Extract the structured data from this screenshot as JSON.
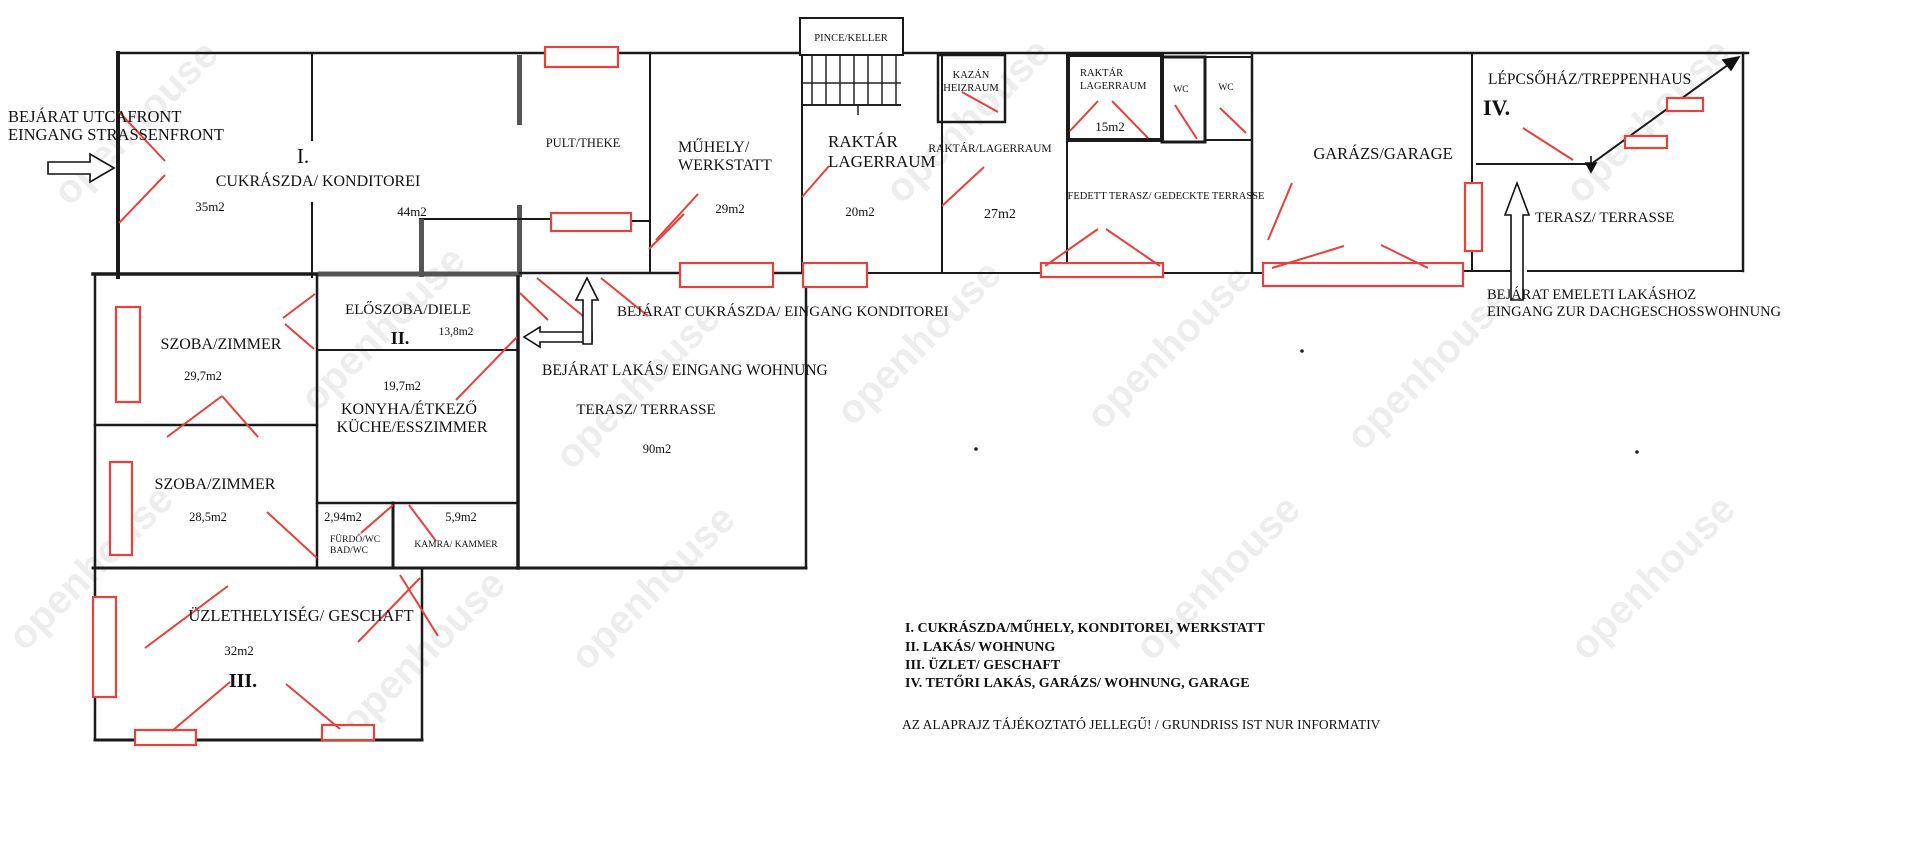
{
  "watermark": "openhouse",
  "entrances": {
    "street_line1": "BEJÁRAT UTCAFRONT",
    "street_line2": "EINGANG STRASSENFRONT",
    "konditorei": "BEJÁRAT CUKRÁSZDA/ EINGANG KONDITOREI",
    "wohnung": "BEJÁRAT LAKÁS/ EINGANG WOHNUNG",
    "upper_line1": "BEJÁRAT EMELETI LAKÁSHOZ",
    "upper_line2": "EINGANG ZUR DACHGESCHOSSWOHNUNG"
  },
  "rooms": {
    "cukraszda": {
      "numeral": "I.",
      "label": "CUKRÁSZDA/ KONDITOREI",
      "area1": "35m2",
      "area2": "44m2"
    },
    "pult": {
      "label": "PULT/THEKE"
    },
    "muhely": {
      "line1": "MŰHELY/",
      "line2": "WERKSTATT",
      "area": "29m2"
    },
    "pince": {
      "label": "PINCE/KELLER"
    },
    "raktar20": {
      "line1": "RAKTÁR",
      "line2": "LAGERRAUM",
      "area": "20m2"
    },
    "kazan": {
      "line1": "KAZÁN",
      "line2": "HEIZRAUM"
    },
    "raktar27": {
      "label": "RAKTÁR/LAGERRAUM",
      "area": "27m2"
    },
    "raktar15": {
      "line1": "RAKTÁR",
      "line2": "LAGERRAUM",
      "area": "15m2"
    },
    "wc1": {
      "label": "WC"
    },
    "wc2": {
      "label": "WC"
    },
    "fedett_terasz": {
      "label": "FEDETT TERASZ/ GEDECKTE TERRASSE"
    },
    "garazs": {
      "label": "GARÁZS/GARAGE"
    },
    "lepcsohaz": {
      "label": "LÉPCSŐHÁZ/TREPPENHAUS",
      "numeral": "IV."
    },
    "terasz_emeleti": {
      "label": "TERASZ/ TERRASSE"
    },
    "szoba1": {
      "label": "SZOBA/ZIMMER",
      "area": "29,7m2"
    },
    "eloszoba": {
      "label": "ELŐSZOBA/DIELE",
      "numeral": "II.",
      "area": "13,8m2"
    },
    "konyha": {
      "area": "19,7m2",
      "line1": "KONYHA/ÉTKEZŐ",
      "line2": "KÜCHE/ESSZIMMER"
    },
    "terasz": {
      "label": "TERASZ/ TERRASSE",
      "area": "90m2"
    },
    "szoba2": {
      "label": "SZOBA/ZIMMER",
      "area": "28,5m2"
    },
    "furdo": {
      "area": "2,94m2",
      "line1": "FÜRDŐ/WC",
      "line2": "BAD/WC"
    },
    "kamra": {
      "area": "5,9m2",
      "label": "KAMRA/ KAMMER"
    },
    "uzlet": {
      "label": "ÜZLETHELYISÉG/ GESCHAFT",
      "area": "32m2",
      "numeral": "III."
    }
  },
  "legend": {
    "items": [
      "I. CUKRÁSZDA/MŰHELY,  KONDITOREI, WERKSTATT",
      "II. LAKÁS/ WOHNUNG",
      "III. ÜZLET/ GESCHAFT",
      "IV. TETŐRI LAKÁS, GARÁZS/  WOHNUNG, GARAGE"
    ],
    "disclaimer": "AZ ALAPRAJZ TÁJÉKOZTATÓ JELLEGŰ! / GRUNDRISS IST NUR INFORMATIV"
  },
  "colors": {
    "wall": "#1a1a1a",
    "gray_wall": "#555555",
    "accent_red": "#e8403a",
    "watermark": "#9a9a9a"
  }
}
